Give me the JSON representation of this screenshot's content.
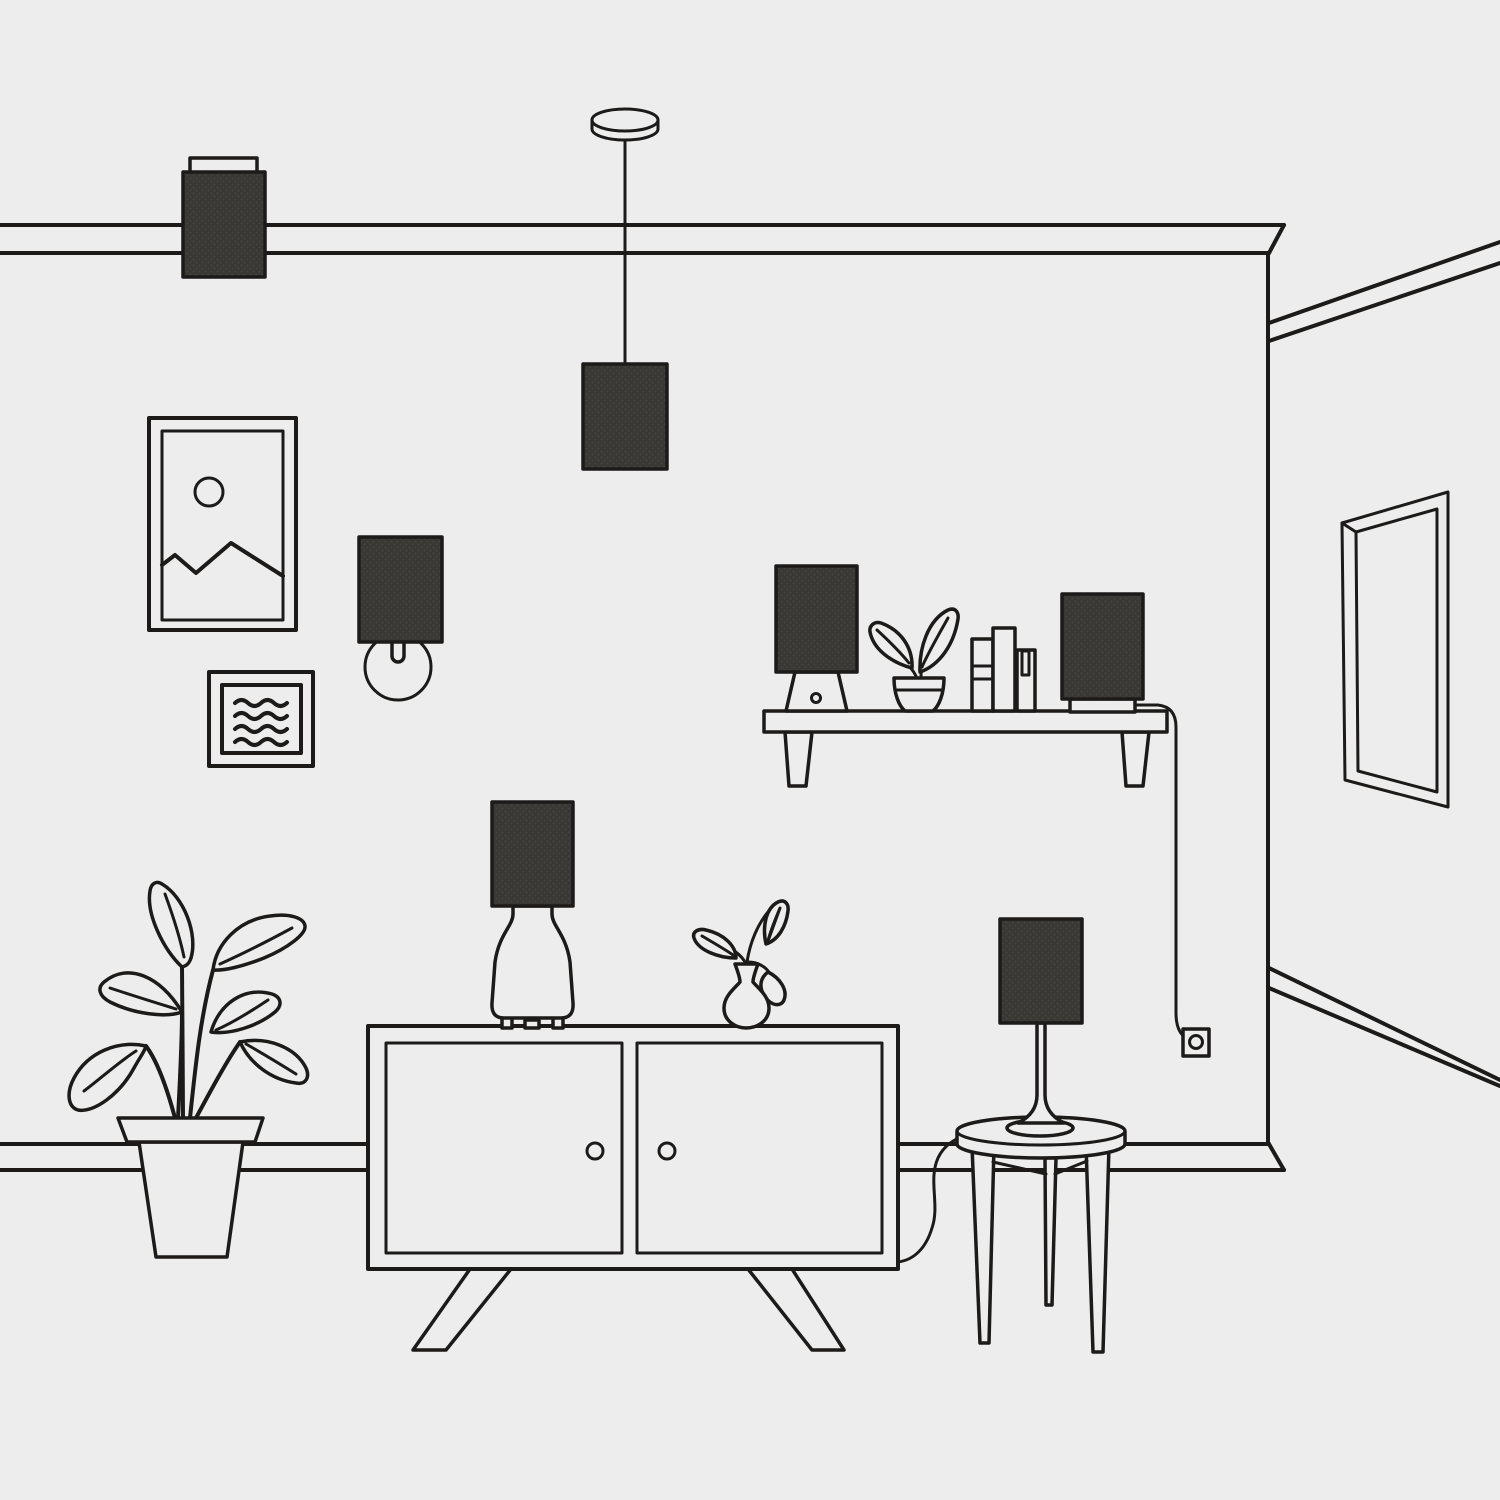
{
  "illustration": {
    "description": "Minimal black line-art illustration of a living room corner: ceiling lamp, pendant lamp, wall art, wall sconce, wall shelf with table lamp, potted plant, books and speaker lamp with cord to an outlet, mirror on the side wall, large floor plant, sideboard with table lamp and bud vase, and a round side table with a slim table lamp",
    "objects": [
      "ceiling-mounted-lamp",
      "pendant-lamp",
      "picture-frame-mountains",
      "picture-frame-abstract",
      "wall-sconce",
      "wall-shelf",
      "shelf-table-lamp",
      "shelf-potted-plant",
      "books",
      "shelf-speaker-lamp",
      "power-cord",
      "wall-outlet",
      "mirror",
      "floor-plant",
      "sideboard",
      "sideboard-table-lamp",
      "bud-vase",
      "side-table",
      "side-table-lamp",
      "picture-rail",
      "baseboard",
      "room-corner"
    ]
  },
  "colors": {
    "background": "#EDEDED",
    "line": "#1C1B1A",
    "lampshade_fill": "#3A3834",
    "lampshade_dot": "#45433F"
  }
}
